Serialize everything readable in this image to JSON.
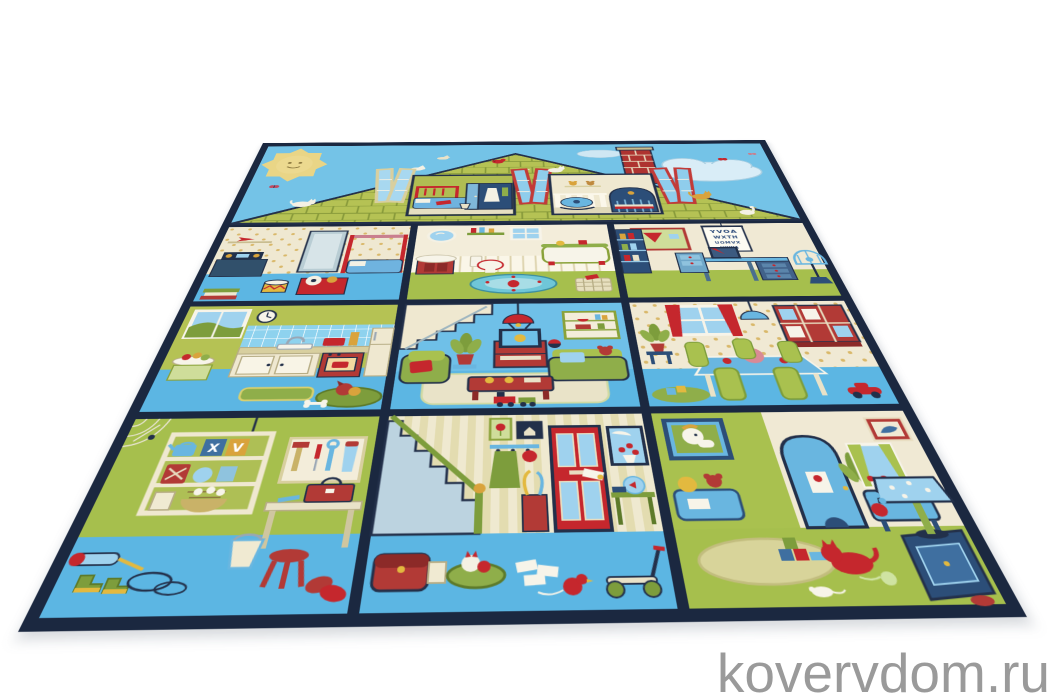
{
  "watermark": {
    "text": "kovervdom.ru",
    "color": "#9a9a9a"
  },
  "rug": {
    "kind": "children's play rug — dollhouse cross-section photographed in perspective on white background",
    "border_color": "#1b2840",
    "palette": {
      "sky": "#74c3e7",
      "roof_green": "#b5c254",
      "grass_green": "#a6bf4d",
      "olive_wall": "#b5c254",
      "floor_blue": "#5cb6e3",
      "cream": "#efe8d0",
      "red": "#c5272d",
      "navy_line": "#23304a",
      "wardrobe_navy": "#2c4e78",
      "light_blue": "#9fd2ee"
    },
    "eye_chart": {
      "lines": [
        "YVOA",
        "WXTH",
        "UOMVX",
        "HYWA"
      ]
    },
    "crate_letters": [
      "X",
      "V"
    ],
    "rooms": [
      "attic bedroom",
      "nursery",
      "kids bedroom",
      "bathroom",
      "study",
      "kitchen",
      "living room",
      "dining room",
      "workshop",
      "hallway",
      "playroom"
    ]
  }
}
